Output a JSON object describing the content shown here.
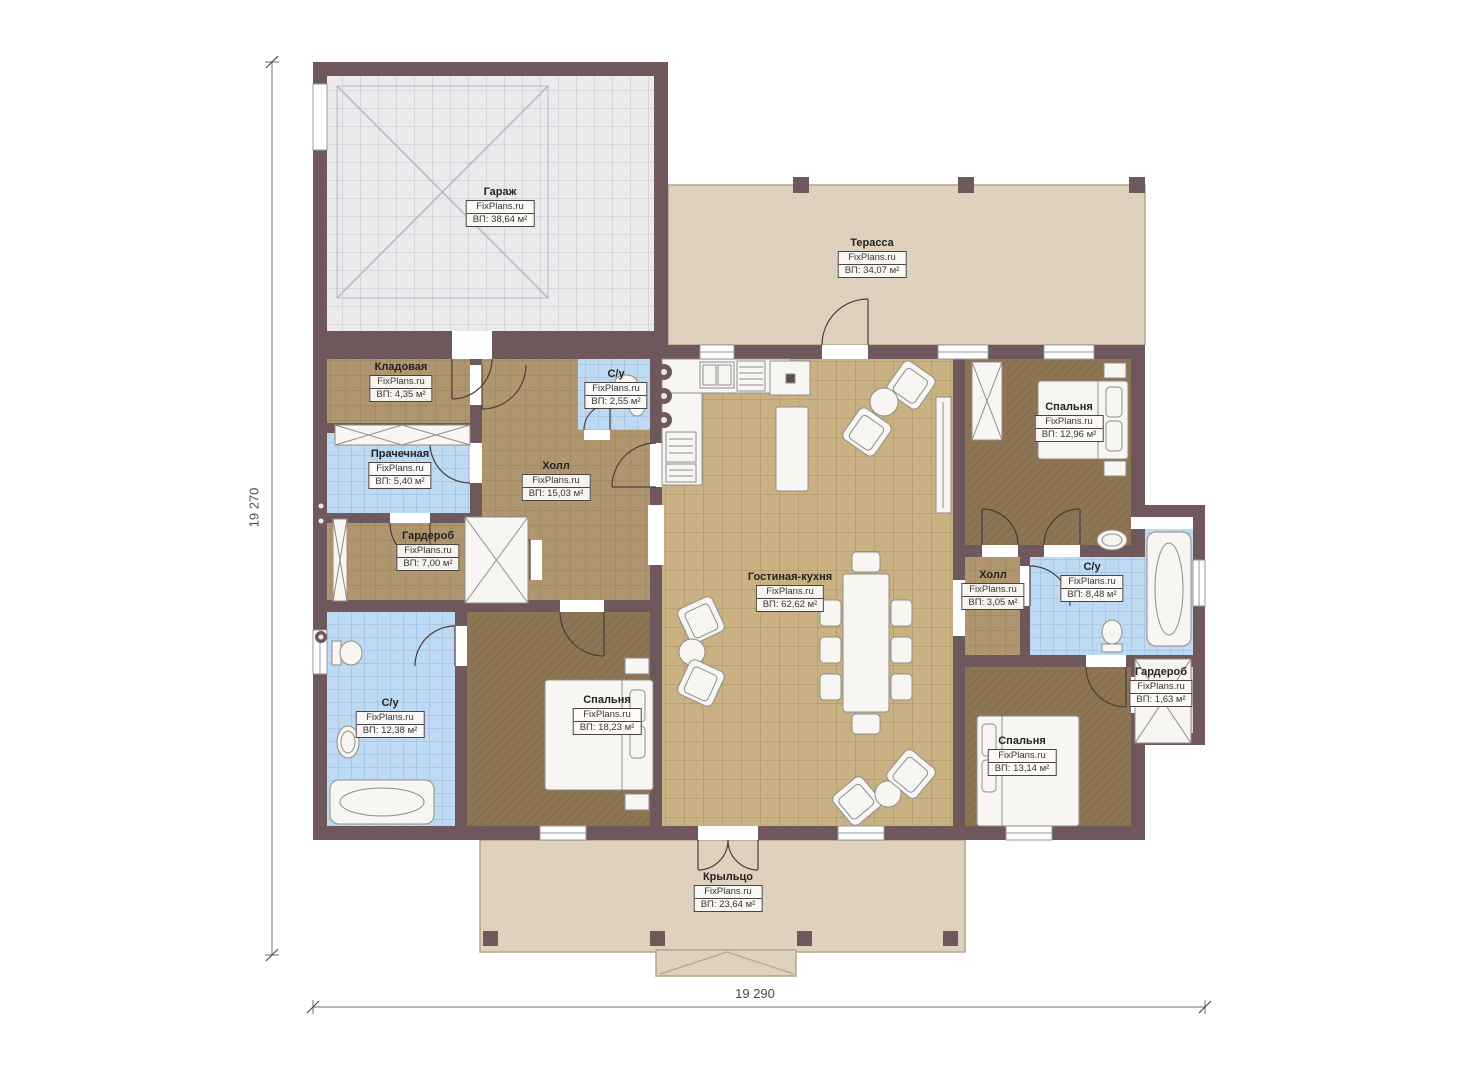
{
  "plan": {
    "brand": "FixPlans.ru",
    "dimensions": {
      "left": "19 270",
      "bottom": "19 290"
    },
    "rooms": [
      {
        "id": "garage",
        "label": "Гараж",
        "area": "ВП: 38,64 м²"
      },
      {
        "id": "terrace",
        "label": "Терасса",
        "area": "ВП: 34,07 м²"
      },
      {
        "id": "storage",
        "label": "Кладовая",
        "area": "ВП: 4,35 м²"
      },
      {
        "id": "bath-top",
        "label": "С/у",
        "area": "ВП: 2,55 м²"
      },
      {
        "id": "laundry",
        "label": "Прачечная",
        "area": "ВП: 5,40 м²"
      },
      {
        "id": "hall-main",
        "label": "Холл",
        "area": "ВП: 15,03 м²"
      },
      {
        "id": "wardrobe-left",
        "label": "Гардероб",
        "area": "ВП: 7,00 м²"
      },
      {
        "id": "bedroom-top-right",
        "label": "Спальня",
        "area": "ВП: 12,96 м²"
      },
      {
        "id": "living-kitchen",
        "label": "Гостиная-кухня",
        "area": "ВП: 62,62 м²"
      },
      {
        "id": "hall-right",
        "label": "Холл",
        "area": "ВП: 3,05 м²"
      },
      {
        "id": "bath-right",
        "label": "С/у",
        "area": "ВП: 8,48 м²"
      },
      {
        "id": "wardrobe-right",
        "label": "Гардероб",
        "area": "ВП: 1,63 м²"
      },
      {
        "id": "bath-left",
        "label": "С/у",
        "area": "ВП: 12,38 м²"
      },
      {
        "id": "bedroom-left",
        "label": "Спальня",
        "area": "ВП: 18,23 м²"
      },
      {
        "id": "bedroom-bottom-right",
        "label": "Спальня",
        "area": "ВП: 13,14 м²"
      },
      {
        "id": "porch",
        "label": "Крыльцо",
        "area": "ВП: 23,64 м²"
      }
    ],
    "colors": {
      "wall": "#6f585b",
      "floor_brown_tile": "#b0966f",
      "floor_living_tile": "#c9b183",
      "floor_bath_tile": "#bedaf3",
      "floor_bedroom": "#8d7453",
      "terrace": "#ded2be",
      "garage_floor": "#eaeaed"
    }
  }
}
